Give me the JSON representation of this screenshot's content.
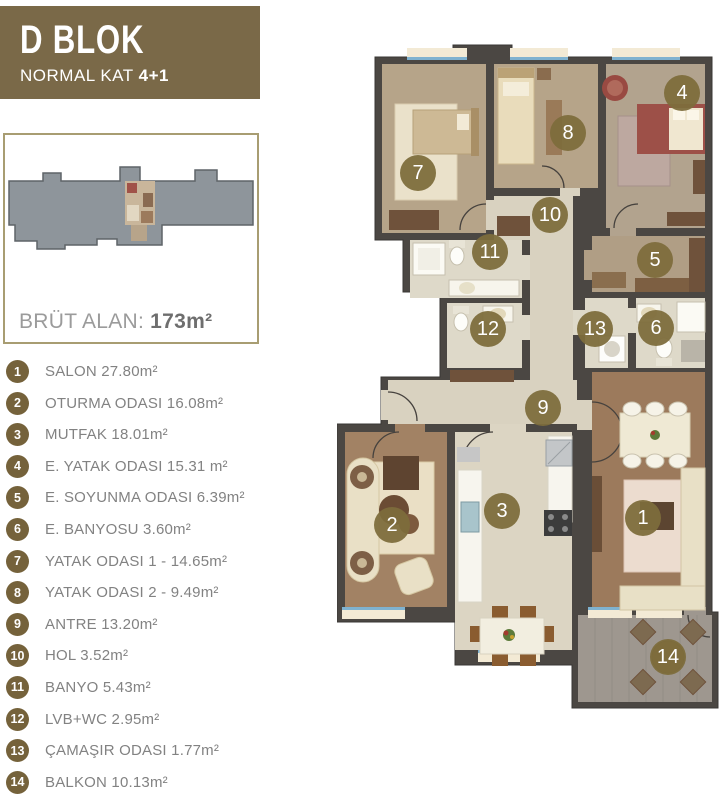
{
  "header": {
    "title": "D BLOK",
    "subtitle": "NORMAL KAT",
    "subtitle_bold": "4+1"
  },
  "overview": {
    "area_label": "BRÜT ALAN:",
    "area_value": "173m²"
  },
  "legend": {
    "items": [
      {
        "num": "1",
        "label": "SALON 27.80m²"
      },
      {
        "num": "2",
        "label": "OTURMA ODASI 16.08m²"
      },
      {
        "num": "3",
        "label": "MUTFAK 18.01m²"
      },
      {
        "num": "4",
        "label": "E. YATAK ODASI 15.31 m²"
      },
      {
        "num": "5",
        "label": "E. SOYUNMA ODASI 6.39m²"
      },
      {
        "num": "6",
        "label": "E. BANYOSU 3.60m²"
      },
      {
        "num": "7",
        "label": "YATAK ODASI 1 - 14.65m²"
      },
      {
        "num": "8",
        "label": "YATAK ODASI 2 - 9.49m²"
      },
      {
        "num": "9",
        "label": "ANTRE 13.20m²"
      },
      {
        "num": "10",
        "label": "HOL 3.52m²"
      },
      {
        "num": "11",
        "label": "BANYO 5.43m²"
      },
      {
        "num": "12",
        "label": "LVB+WC 2.95m²"
      },
      {
        "num": "13",
        "label": "ÇAMAŞIR ODASI 1.77m²"
      },
      {
        "num": "14",
        "label": "BALKON 10.13m²"
      }
    ]
  },
  "plan": {
    "markers": [
      {
        "num": "1",
        "x": 306,
        "y": 478
      },
      {
        "num": "2",
        "x": 55,
        "y": 485
      },
      {
        "num": "3",
        "x": 165,
        "y": 471
      },
      {
        "num": "4",
        "x": 345,
        "y": 53
      },
      {
        "num": "5",
        "x": 318,
        "y": 220
      },
      {
        "num": "6",
        "x": 319,
        "y": 288
      },
      {
        "num": "7",
        "x": 81,
        "y": 133
      },
      {
        "num": "8",
        "x": 231,
        "y": 93
      },
      {
        "num": "9",
        "x": 206,
        "y": 368
      },
      {
        "num": "10",
        "x": 213,
        "y": 175
      },
      {
        "num": "11",
        "x": 153,
        "y": 212
      },
      {
        "num": "12",
        "x": 151,
        "y": 289
      },
      {
        "num": "13",
        "x": 258,
        "y": 289
      },
      {
        "num": "14",
        "x": 331,
        "y": 617
      }
    ]
  },
  "colors": {
    "accent_brown": "#7a6948",
    "legend_circle": "#75623b",
    "marker_circle": "#7d6c3c",
    "legend_text": "#828282",
    "area_value": "#6e6e6e",
    "box_border": "#a89d72",
    "wall": "#4b4743",
    "window_blue": "#7fb2d0",
    "silhouette_gray": "#8e959b"
  }
}
